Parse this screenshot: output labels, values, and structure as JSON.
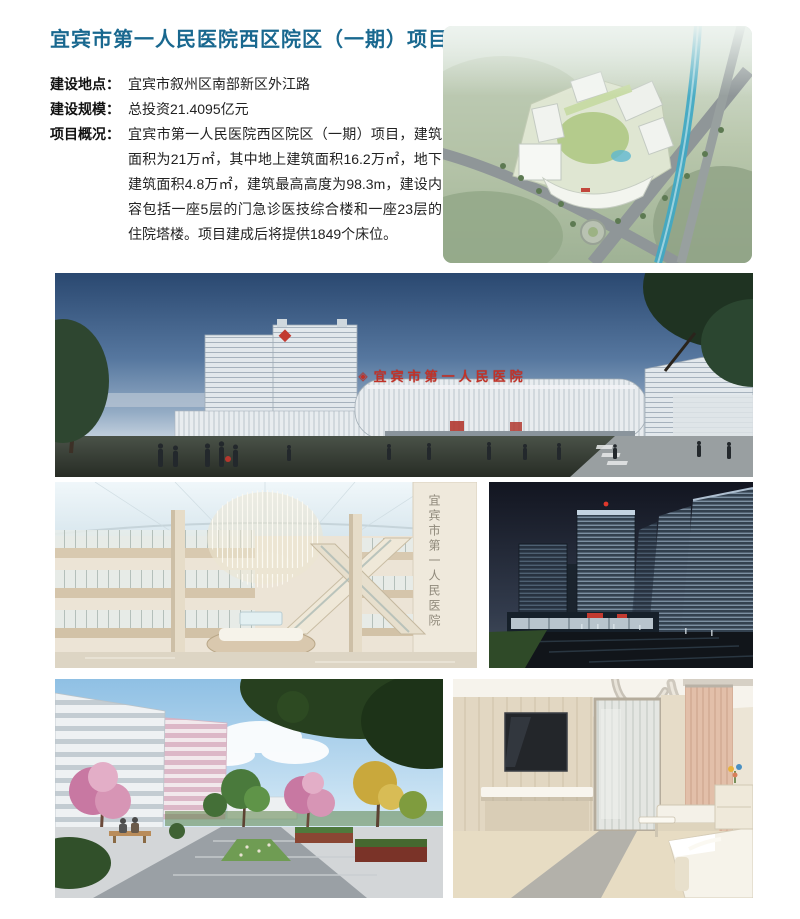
{
  "page": {
    "title": "宜宾市第一人民医院西区院区（一期）项目"
  },
  "details": [
    {
      "label": "建设地点：",
      "value": "宜宾市叙州区南部新区外江路"
    },
    {
      "label": "建设规模：",
      "value": "总投资21.4095亿元"
    },
    {
      "label": "项目概况：",
      "value": "宜宾市第一人民医院西区院区（一期）项目，建筑面积为21万㎡，其中地上建筑面积16.2万㎡，地下建筑面积4.8万㎡，建筑最高高度为98.3m，建设内容包括一座5层的门急诊医技综合楼和一座23层的住院塔楼。项目建成后将提供1849个床位。"
    }
  ],
  "photos": {
    "panorama": {
      "logo_glyph": "◈",
      "facade_sign": "宜宾市第一人民医院"
    },
    "atrium": {
      "wall_sign_vertical": "宜宾市第一人民医院"
    }
  },
  "colors": {
    "title_teal": "#19688f",
    "sign_red": "#c13228"
  }
}
